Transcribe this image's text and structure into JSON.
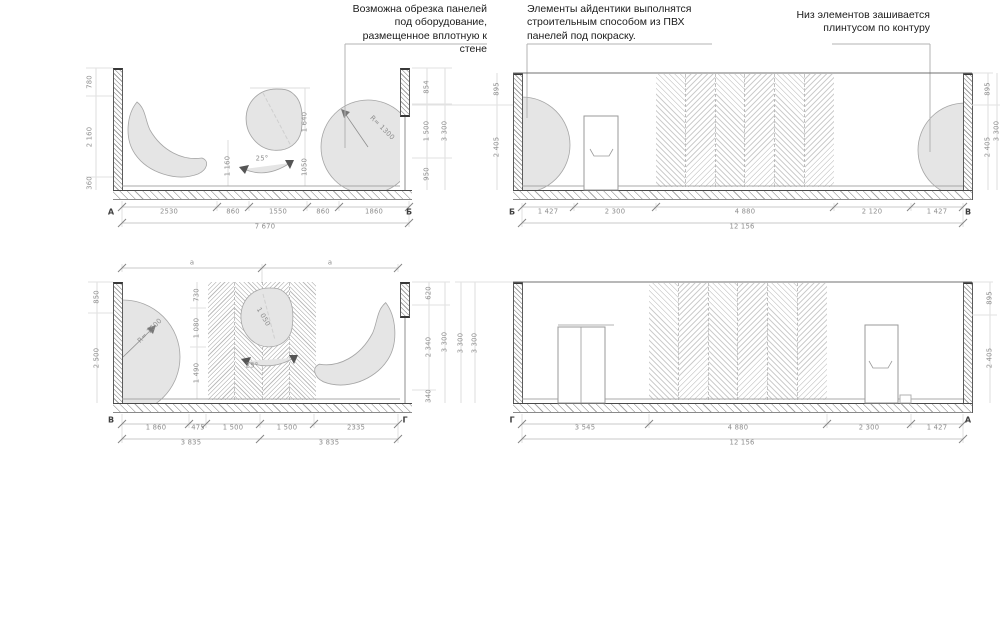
{
  "annotations": {
    "a1": "Возможна обрезка панелей под оборудование, размещенное вплотную к стене",
    "a2": "Элементы айдентики выполнятся строительным способом из ПВХ панелей под покраску.",
    "a3": "Низ элементов зашивается плинтусом по контуру"
  },
  "drawings": {
    "top_left": {
      "marker_left": "А",
      "marker_right": "Б",
      "bottom": [
        "2530",
        "860",
        "1550",
        "860",
        "1860"
      ],
      "total": "7 670",
      "left": [
        "780",
        "2 160",
        "360"
      ],
      "right": [
        "854",
        "1 500",
        "950"
      ],
      "right_total": "3 300",
      "inner": [
        "1 160",
        "1 640",
        "1050"
      ],
      "radius": "R= 1300",
      "angle": "25°"
    },
    "top_right": {
      "marker_left": "Б",
      "marker_right": "В",
      "bottom": [
        "1 427",
        "2 300",
        "4 880",
        "2 120",
        "1 427"
      ],
      "total": "12 156",
      "left": [
        "895",
        "2 405"
      ],
      "right": [
        "895",
        "2 405"
      ],
      "right_total": "3 300"
    },
    "bottom_left": {
      "marker_left": "В",
      "marker_right": "Г",
      "equal_marks": [
        "а",
        "а"
      ],
      "bottom": [
        "1 860",
        "475",
        "1 500",
        "1 500",
        "2335"
      ],
      "totals": [
        "3 835",
        "3 835"
      ],
      "left": [
        "850",
        "2 500"
      ],
      "inner": [
        "730",
        "1 080",
        "1 490"
      ],
      "right": [
        "620",
        "2 340",
        "340"
      ],
      "right_total": "3 300",
      "radius": "R= 1500",
      "blob_dim": "1 050",
      "angle": "25°"
    },
    "bottom_right": {
      "marker_left": "Г",
      "marker_right": "А",
      "bottom": [
        "3 545",
        "4 880",
        "2 300",
        "1 427"
      ],
      "total": "12 156",
      "left": [
        "3 300",
        "3 300"
      ],
      "right": [
        "895",
        "2 405"
      ]
    }
  },
  "colors": {
    "blob_fill": "#e5e5e5",
    "hatch": "#a8a8a8",
    "dim_text": "#8e8e8e",
    "annotation_text": "#1b1b1b"
  }
}
